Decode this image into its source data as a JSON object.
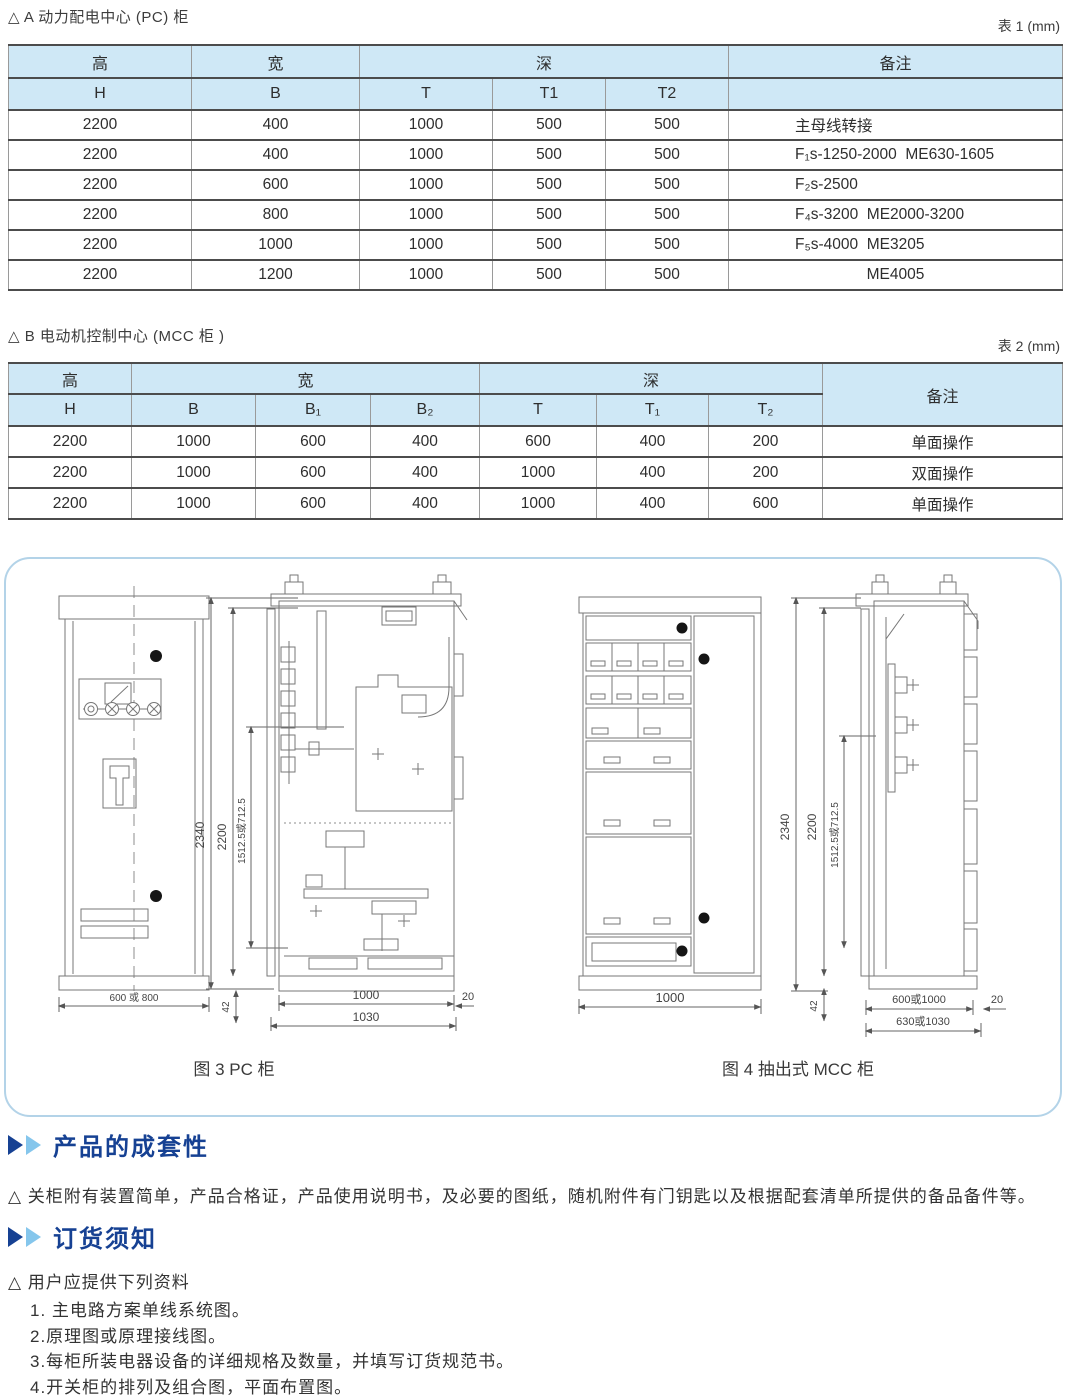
{
  "sectionA": {
    "title": "△ A 动力配电中心 (PC) 柜",
    "table_tag": "表 1 (mm)"
  },
  "table1": {
    "h1": {
      "height": "高",
      "width": "宽",
      "depth": "深",
      "note": "备注"
    },
    "h2": [
      "H",
      "B",
      "T",
      "T1",
      "T2"
    ],
    "rows": [
      [
        "2200",
        "400",
        "1000",
        "500",
        "500",
        "主母线转接"
      ],
      [
        "2200",
        "400",
        "1000",
        "500",
        "500",
        "F₁s-1250-2000  ME630-1605"
      ],
      [
        "2200",
        "600",
        "1000",
        "500",
        "500",
        "F₂s-2500"
      ],
      [
        "2200",
        "800",
        "1000",
        "500",
        "500",
        "F₄s-3200  ME2000-3200"
      ],
      [
        "2200",
        "1000",
        "1000",
        "500",
        "500",
        "F₅s-4000  ME3205"
      ],
      [
        "2200",
        "1200",
        "1000",
        "500",
        "500",
        "ME4005"
      ]
    ]
  },
  "sectionB": {
    "title": "△ B 电动机控制中心 (MCC 柜 )",
    "table_tag": "表 2 (mm)"
  },
  "table2": {
    "h1": {
      "height": "高",
      "width": "宽",
      "depth": "深",
      "note": "备注"
    },
    "h2": [
      "H",
      "B",
      "B₁",
      "B₂",
      "T",
      "T₁",
      "T₂"
    ],
    "rows": [
      [
        "2200",
        "1000",
        "600",
        "400",
        "600",
        "400",
        "200",
        "单面操作"
      ],
      [
        "2200",
        "1000",
        "600",
        "400",
        "1000",
        "400",
        "200",
        "双面操作"
      ],
      [
        "2200",
        "1000",
        "600",
        "400",
        "1000",
        "400",
        "600",
        "单面操作"
      ]
    ]
  },
  "figures": {
    "fig3_caption": "图 3 PC 柜",
    "fig4_caption": "图 4 抽出式 MCC 柜",
    "pc_front": {
      "width_dim": "600 或 800"
    },
    "pc_side": {
      "h_total": "2340",
      "h_body": "2200",
      "h_inner": "1512.5或712.5",
      "base_h": "42",
      "d_body": "1000",
      "d_door": "20",
      "d_total": "1030"
    },
    "mcc_front": {
      "width_dim": "1000"
    },
    "mcc_side": {
      "h_total": "2340",
      "h_body": "2200",
      "h_inner": "1512.5或712.5",
      "base_h": "42",
      "d_body": "600或1000",
      "d_door": "20",
      "d_total": "630或1030"
    }
  },
  "sections": {
    "completeness": {
      "heading": "产品的成套性",
      "body": "△ 关柜附有装置简单，产品合格证，产品使用说明书，及必要的图纸，随机附件有门钥匙以及根据配套清单所提供的备品备件等。"
    },
    "ordering": {
      "heading": "订货须知",
      "intro": "△ 用户应提供下列资料",
      "items": [
        "1. 主电路方案单线系统图。",
        "2.原理图或原理接线图。",
        "3.每柜所装电器设备的详细规格及数量，并填写订货规范书。",
        "4.开关柜的排列及组合图，平面布置图。"
      ]
    }
  },
  "colors": {
    "header_bg": "#cfe8f6",
    "heading_blue": "#164193",
    "arrow_light": "#85c6ec",
    "panel_border": "#b3d3e8"
  }
}
